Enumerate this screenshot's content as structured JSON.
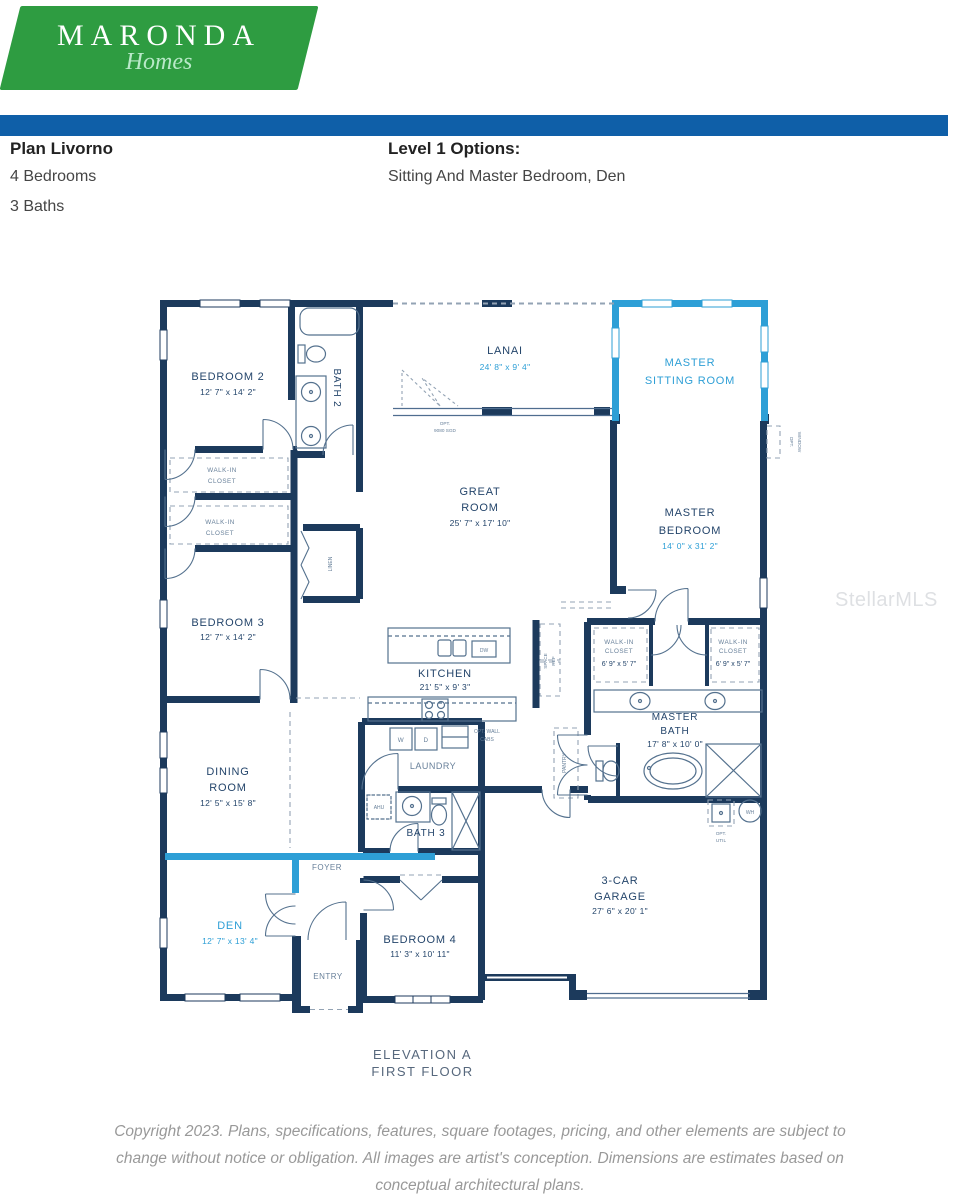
{
  "header": {
    "logo": {
      "line1": "MARONDA",
      "line2": "Homes"
    },
    "plan": {
      "title": "Plan Livorno",
      "bedrooms": "4 Bedrooms",
      "baths": "3 Baths"
    },
    "options": {
      "title": "Level 1 Options:",
      "value": "Sitting And Master Bedroom, Den"
    }
  },
  "colors": {
    "logo_green": "#2e9c41",
    "bar_blue": "#0f5fa8",
    "wall_navy": "#1c3a5c",
    "optional_cyan": "#2e9fd6"
  },
  "floorplan": {
    "rooms": {
      "bedroom2": {
        "name": "BEDROOM 2",
        "dims": "12' 7\" x 14' 2\""
      },
      "bath2": {
        "name": "BATH 2"
      },
      "wic_bed2": {
        "l1": "WALK-IN",
        "l2": "CLOSET"
      },
      "wic_bed3": {
        "l1": "WALK-IN",
        "l2": "CLOSET"
      },
      "lanai": {
        "name": "LANAI",
        "dims": "24' 8\" x 9' 4\""
      },
      "master_sitting": {
        "l1": "MASTER",
        "l2": "SITTING ROOM"
      },
      "great_room": {
        "l1": "GREAT",
        "l2": "ROOM",
        "dims": "25' 7\" x 17' 10\""
      },
      "master_bedroom": {
        "l1": "MASTER",
        "l2": "BEDROOM",
        "dims": "14' 0\" x 31' 2\""
      },
      "linen": {
        "name": "LINEN"
      },
      "bedroom3": {
        "name": "BEDROOM 3",
        "dims": "12' 7\" x 14' 2\""
      },
      "kitchen": {
        "name": "KITCHEN",
        "dims": "21' 5\" x 9' 3\""
      },
      "ref_space": {
        "l1": "REF",
        "l2": "SPACE"
      },
      "wic_master_left": {
        "l1": "WALK-IN",
        "l2": "CLOSET",
        "dims": "6' 9\" x 5' 7\""
      },
      "wic_master_right": {
        "l1": "WALK-IN",
        "l2": "CLOSET",
        "dims": "6' 9\" x 5' 7\""
      },
      "master_bath": {
        "l1": "MASTER",
        "l2": "BATH",
        "dims": "17' 8\" x 10' 0\""
      },
      "pantry": {
        "name": "PANTRY"
      },
      "laundry": {
        "name": "LAUNDRY"
      },
      "opt_wall_cabs": {
        "l1": "OPT. WALL",
        "l2": "CABS"
      },
      "washer": "W",
      "dryer": "D",
      "dishwasher": "DW",
      "dining": {
        "l1": "DINING",
        "l2": "ROOM",
        "dims": "12' 5\" x 15' 8\""
      },
      "bath3": {
        "name": "BATH 3"
      },
      "ahu": {
        "name": "AHU"
      },
      "foyer": {
        "name": "FOYER"
      },
      "den": {
        "name": "DEN",
        "dims": "12' 7\" x 13' 4\""
      },
      "entry": {
        "name": "ENTRY"
      },
      "bedroom4": {
        "name": "BEDROOM 4",
        "dims": "11' 3\" x 10' 11\""
      },
      "garage": {
        "l1": "3-CAR",
        "l2": "GARAGE",
        "dims": "27' 6\" x 20' 1\""
      },
      "water_heater": "WH",
      "opt_util": {
        "l1": "OPT.",
        "l2": "UTIL"
      },
      "opt_sgd": {
        "l1": "OPT.",
        "l2": "9080 SGD"
      },
      "opt_window": {
        "l1": "OPT.",
        "l2": "WINDOW"
      }
    },
    "caption": {
      "line1": "ELEVATION A",
      "line2": "FIRST FLOOR"
    }
  },
  "watermark": "StellarMLS",
  "footer": {
    "line1": "Copyright 2023. Plans, specifications, features, square footages, pricing, and other elements are subject to",
    "line2": "change without notice or obligation. All images are artist's conception. Dimensions are estimates based on",
    "line3": "conceptual architectural plans."
  }
}
